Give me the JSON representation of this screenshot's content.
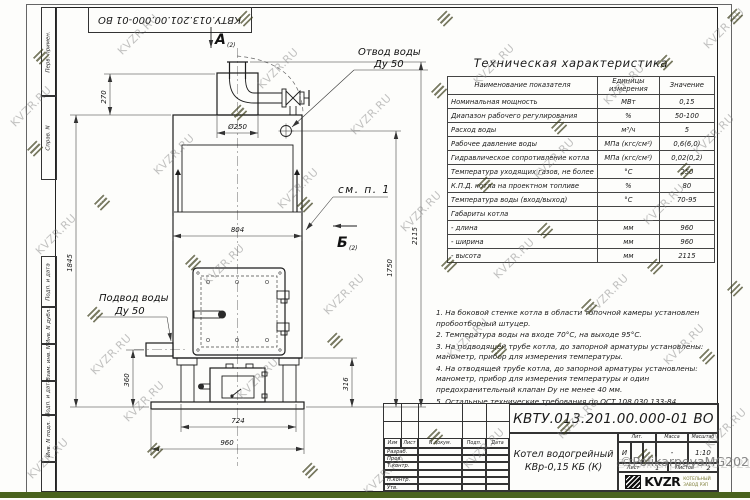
{
  "watermark": {
    "text": "KVZR.RU",
    "copyright": "©PolikarpovaMG2021"
  },
  "stamp_top": "КВТУ.013.201.00.000-01 ВО",
  "margin": {
    "labels": [
      "Перв. примен.",
      "Справ. N",
      "Подп. и дата",
      "Инв. N дубл.",
      "Взам. инв. N",
      "Подп. и дата",
      "Инв. N подл."
    ]
  },
  "spec": {
    "title": "Техническая характеристика",
    "col_name": "Наименование показателя",
    "col_unit": "Единицы измерения",
    "col_value": "Значение",
    "rows": [
      {
        "name": "Номинальная мощность",
        "unit": "МВт",
        "value": "0,15"
      },
      {
        "name": "Диапазон рабочего регулирования",
        "unit": "%",
        "value": "50-100"
      },
      {
        "name": "Расход воды",
        "unit": "м³/ч",
        "value": "5"
      },
      {
        "name": "Рабочее давление воды",
        "unit": "МПа (кгс/см²)",
        "value": "0,6(6,0)"
      },
      {
        "name": "Гидравлическое сопротивление котла",
        "unit": "МПа (кгс/см²)",
        "value": "0,02(0,2)"
      },
      {
        "name": "Температура уходящих газов, не более",
        "unit": "°С",
        "value": "250"
      },
      {
        "name": "К.П.Д. котла на проектном топливе",
        "unit": "%",
        "value": "80"
      },
      {
        "name": "Температура воды (вход/выход)",
        "unit": "°С",
        "value": "70-95"
      },
      {
        "name": "Габариты котла",
        "unit": "",
        "value": ""
      },
      {
        "name": "- длина",
        "unit": "мм",
        "value": "960"
      },
      {
        "name": "- ширина",
        "unit": "мм",
        "value": "960"
      },
      {
        "name": "- высота",
        "unit": "мм",
        "value": "2115"
      }
    ]
  },
  "notes": {
    "items": [
      "1. На боковой стенке котла в области топочной камеры установлен пробоотборный штуцер.",
      "2. Температура воды на входе 70°С, на выходе 95°С.",
      "3. На подводящей трубе котла, до запорной арматуры установлены: манометр, прибор для измерения температуры.",
      "4. На отводящей трубе котла, до запорной арматуры установлены: манометр, прибор для измерения температуры и один предохранительный клапан Dy не менее 40 мм.",
      "5. Остальные технические требования по ОСТ 108.030.133-84."
    ]
  },
  "drawing": {
    "view_a": "А",
    "view_a_sub": "(2)",
    "view_b": "Б",
    "view_b_sub": "(2)",
    "outlet_line1": "Отвод воды",
    "outlet_line2": "Ду 50",
    "inlet_line1": "Подвод воды",
    "inlet_line2": "Ду 50",
    "see_note": "см. п. 1",
    "dims": {
      "d270": "270",
      "d250": "Ø250",
      "d804": "804",
      "d1845": "1845",
      "d360": "360",
      "d724": "724",
      "d960": "960",
      "d316": "316",
      "d1750": "1750",
      "d2115": "2115"
    }
  },
  "titleblock": {
    "doc_number": "КВТУ.013.201.00.000-01 ВО",
    "product_line1": "Котел водогрейный",
    "product_line2": "КВр-0,15 КБ (К)",
    "header_cells": [
      "Изм",
      "Лист",
      "N докум.",
      "Подп.",
      "Дата"
    ],
    "row_labels": [
      "Разраб.",
      "Пров.",
      "Т.контр.",
      "",
      "Н.контр.",
      "Утв."
    ],
    "lit_label": "Лит.",
    "mass_label": "Масса",
    "scale_label": "Масштаб",
    "lit": "И",
    "mass": "-",
    "scale": "1:10",
    "sheet_label": "Лист",
    "sheet": "1",
    "sheets_label": "Листов",
    "sheets": "2",
    "org": "KVZR",
    "org_line1": "КОТЕЛЬНЫЙ",
    "org_line2": "ЗАВОД РЭП",
    "format": "Формат А3"
  }
}
